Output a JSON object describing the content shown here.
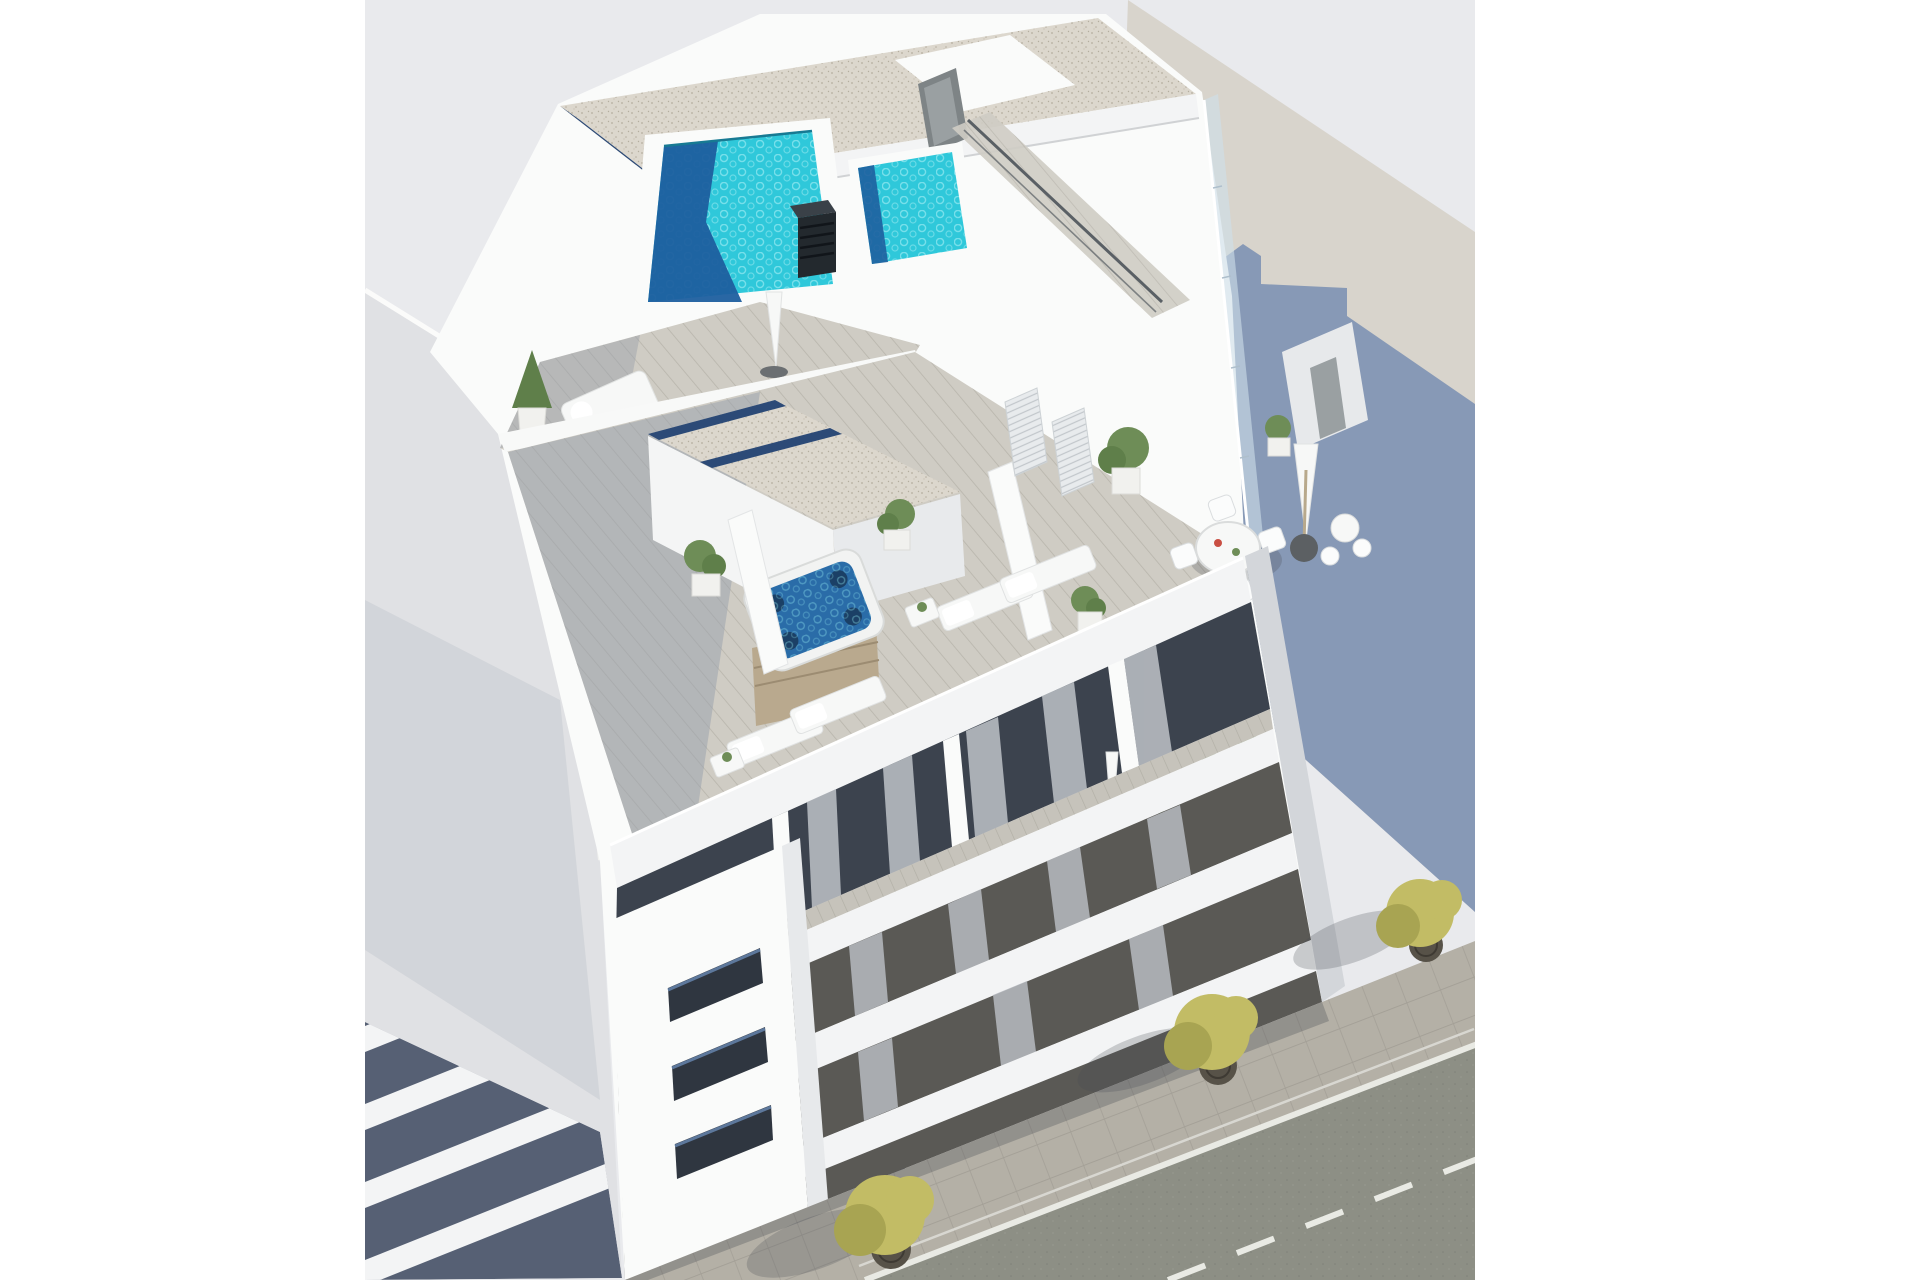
{
  "scene": {
    "type": "architectural_3d_render",
    "view": "aerial axonometric",
    "subject": "modern white apartment building with rooftop pools and terraces",
    "environment": "urban street corner with adjacent buildings and sidewalk trees",
    "rooftop_features": [
      "swimming-pool",
      "plunge-pool",
      "jacuzzi",
      "gravel-roof-with-skylights",
      "wood-deck-terraces",
      "sun-loungers",
      "daybeds",
      "parasols",
      "round-dining-set",
      "bar-table-with-stools",
      "potted-plants",
      "glass-balustrade",
      "stair-bulkhead-door",
      "black-chimney",
      "handrail-walkway"
    ],
    "facade_features": [
      "white-balcony-slabs",
      "dark-recessed-glazing",
      "curtains",
      "corner-volume-with-window-slots",
      "penthouse-terrace-sofa",
      "balcony-round-table"
    ],
    "street_features": [
      "paved-sidewalk",
      "street-trees-with-grates",
      "asphalt-road",
      "solid-edge-line",
      "dashed-center-line"
    ],
    "adjacent_buildings": [
      "left-neighbor-with-balcony-bands",
      "right-neighbor-with-cast-shadow"
    ]
  },
  "colors": {
    "page_bg": "#ffffff",
    "photo_bg": "#e9eaed",
    "warm_wall": "#d8d4cc",
    "cast_shadow_blue": "#8094b4",
    "neighbor_roof": "#e0e1e4",
    "neighbor_wall_sunlit": "#f7f5f0",
    "band_dark": "#566074",
    "slab_white": "#f3f4f5",
    "white_wall": "#fafbfa",
    "wall_shade": "#e7e9eb",
    "wall_dark_face": "#d3d6da",
    "gravel": "#dcd7cd",
    "gravel_dot": "#b5ae9f",
    "skylight_blue": "#2c4a77",
    "pool_turquoise": "#2fc8da",
    "pool_ripple": "#8fe6ef",
    "pool_deep": "#1e5f9f",
    "jacuzzi_water": "#2a6ca8",
    "jacuzzi_seat": "#1a3c5e",
    "chimney_dark": "#23292e",
    "deck_light": "#cfccc4",
    "deck_plank": "#b8b5ac",
    "deck_shade": "#98a0ab",
    "facade_dark": "#5a5955",
    "curtain_gray": "#b7bbc1",
    "glass_dark": "#3c434e",
    "window_slot": "#2f3640",
    "glass_blue": "#cfe0ea",
    "rail_dark": "#5a6065",
    "terrace_floor": "#c6c3bb",
    "sidewalk": "#b4b0a6",
    "paver_joint": "#a39f96",
    "asphalt": "#8d8f85",
    "road_line": "#e9eae4",
    "tree_yellow": "#c2bc65",
    "tree_dark": "#a8a452",
    "plant_green": "#6e8d57",
    "plant_green_dark": "#5f7f4a",
    "pot_white": "#f1f1ee",
    "shadow_soft": "rgba(70,76,82,0.25)",
    "furniture_white": "#f7f8f7",
    "sofa_cushion": "#d9dee3",
    "wood_tan": "#b9a98e",
    "metal_door": "#9aa0a2"
  }
}
